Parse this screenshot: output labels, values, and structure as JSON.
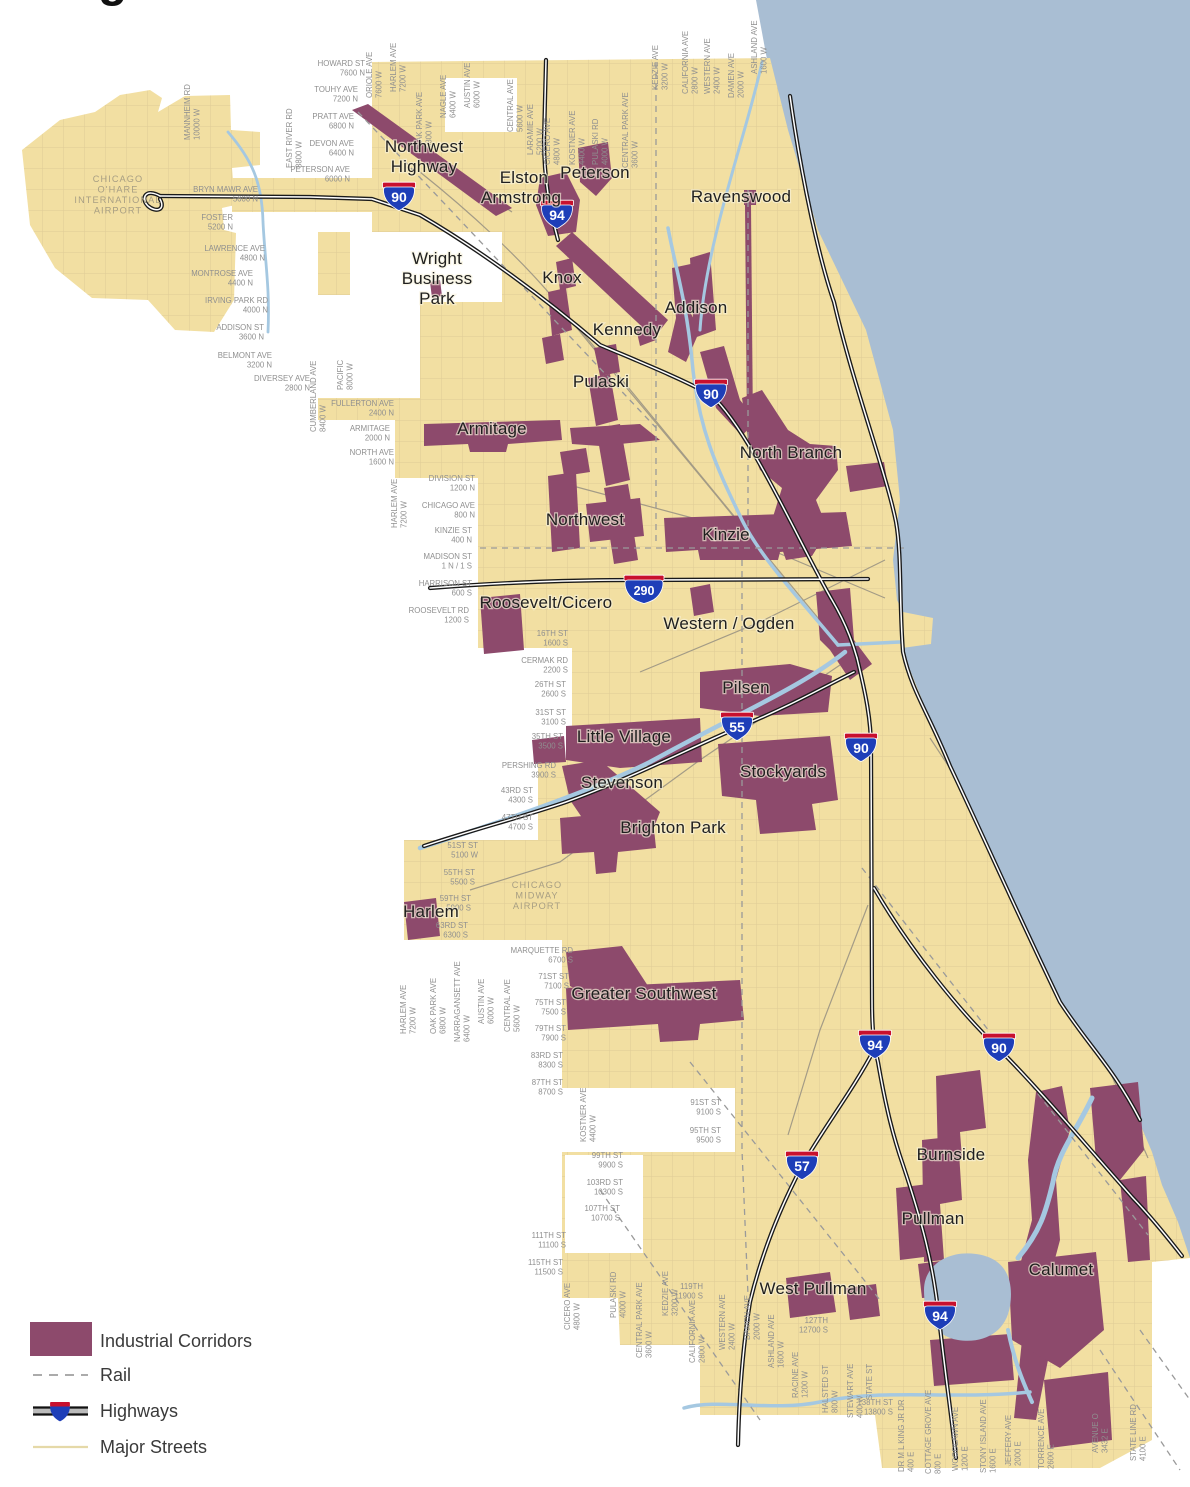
{
  "title_fragment": "g",
  "colors": {
    "land": "#F2DFA2",
    "lake": "#A9BED3",
    "river": "#A5C8E1",
    "corridor": "#8D4A6C",
    "street_grid": "#DFCB96",
    "rail": "#9A9A9A",
    "highway": "#1A1A1A",
    "shield_blue": "#1E3EB8",
    "shield_red": "#C8102E",
    "label_gray": "#8F8F8F"
  },
  "legend": {
    "items": [
      {
        "label": "Industrial Corridors",
        "symbol": "corridor-swatch"
      },
      {
        "label": "Rail",
        "symbol": "rail-dashed-line"
      },
      {
        "label": "Highways",
        "symbol": "highway-shield-line"
      },
      {
        "label": "Major Streets",
        "symbol": "street-line"
      }
    ]
  },
  "map": {
    "airport_labels": [
      {
        "lines": [
          "CHICAGO",
          "O'HARE",
          "INTERNATIONAL",
          "AIRPORT"
        ],
        "x": 118,
        "y": 182
      },
      {
        "lines": [
          "CHICAGO",
          "MIDWAY",
          "AIRPORT"
        ],
        "x": 537,
        "y": 888
      }
    ],
    "corridor_labels": [
      {
        "lines": [
          "Northwest",
          "Highway"
        ],
        "x": 424,
        "y": 152
      },
      {
        "lines": [
          "Elston"
        ],
        "x": 524,
        "y": 183
      },
      {
        "lines": [
          "Armstrong"
        ],
        "x": 521,
        "y": 203
      },
      {
        "lines": [
          "Peterson"
        ],
        "x": 595,
        "y": 178
      },
      {
        "lines": [
          "Ravenswood"
        ],
        "x": 741,
        "y": 202
      },
      {
        "lines": [
          "Wright",
          "Business",
          "Park"
        ],
        "x": 437,
        "y": 264
      },
      {
        "lines": [
          "Knox"
        ],
        "x": 562,
        "y": 283
      },
      {
        "lines": [
          "Addison"
        ],
        "x": 696,
        "y": 313
      },
      {
        "lines": [
          "Kennedy"
        ],
        "x": 627,
        "y": 335
      },
      {
        "lines": [
          "Pulaski"
        ],
        "x": 601,
        "y": 387
      },
      {
        "lines": [
          "Armitage"
        ],
        "x": 492,
        "y": 434
      },
      {
        "lines": [
          "North Branch"
        ],
        "x": 791,
        "y": 458
      },
      {
        "lines": [
          "Northwest"
        ],
        "x": 585,
        "y": 525
      },
      {
        "lines": [
          "Kinzie"
        ],
        "x": 726,
        "y": 540
      },
      {
        "lines": [
          "Roosevelt/Cicero"
        ],
        "x": 546,
        "y": 608
      },
      {
        "lines": [
          "Western / Ogden"
        ],
        "x": 729,
        "y": 629
      },
      {
        "lines": [
          "Pilsen"
        ],
        "x": 746,
        "y": 693
      },
      {
        "lines": [
          "Little Village"
        ],
        "x": 624,
        "y": 742
      },
      {
        "lines": [
          "Stevenson"
        ],
        "x": 622,
        "y": 788
      },
      {
        "lines": [
          "Stockyards"
        ],
        "x": 783,
        "y": 777
      },
      {
        "lines": [
          "Brighton Park"
        ],
        "x": 673,
        "y": 833
      },
      {
        "lines": [
          "Harlem"
        ],
        "x": 431,
        "y": 917
      },
      {
        "lines": [
          "Greater Southwest"
        ],
        "x": 644,
        "y": 999
      },
      {
        "lines": [
          "Burnside"
        ],
        "x": 951,
        "y": 1160
      },
      {
        "lines": [
          "Pullman"
        ],
        "x": 933,
        "y": 1224
      },
      {
        "lines": [
          "West Pullman"
        ],
        "x": 813,
        "y": 1294
      },
      {
        "lines": [
          "Calumet"
        ],
        "x": 1061,
        "y": 1275
      }
    ],
    "highway_shields": [
      {
        "route": "90",
        "x": 399,
        "y": 197
      },
      {
        "route": "94",
        "x": 557,
        "y": 215
      },
      {
        "route": "90",
        "x": 711,
        "y": 394
      },
      {
        "route": "290",
        "x": 644,
        "y": 590
      },
      {
        "route": "55",
        "x": 737,
        "y": 727
      },
      {
        "route": "90",
        "x": 861,
        "y": 748
      },
      {
        "route": "94",
        "x": 875,
        "y": 1045
      },
      {
        "route": "90",
        "x": 999,
        "y": 1048
      },
      {
        "route": "57",
        "x": 802,
        "y": 1166
      },
      {
        "route": "94",
        "x": 940,
        "y": 1316
      }
    ],
    "street_labels": [
      {
        "t": "HOWARD ST",
        "v": "7600 N",
        "x": 365,
        "y": 66
      },
      {
        "t": "TOUHY AVE",
        "v": "7200 N",
        "x": 358,
        "y": 92
      },
      {
        "t": "PRATT AVE",
        "v": "6800 N",
        "x": 354,
        "y": 119
      },
      {
        "t": "DEVON AVE",
        "v": "6400 N",
        "x": 354,
        "y": 146
      },
      {
        "t": "PETERSON AVE",
        "v": "6000 N",
        "x": 350,
        "y": 172
      },
      {
        "t": "BRYN MAWR AVE",
        "v": "5600 N",
        "x": 258,
        "y": 192
      },
      {
        "t": "FOSTER",
        "v": "5200 N",
        "x": 233,
        "y": 220
      },
      {
        "t": "LAWRENCE AVE",
        "v": "4800 N",
        "x": 265,
        "y": 251
      },
      {
        "t": "MONTROSE AVE",
        "v": "4400 N",
        "x": 253,
        "y": 276
      },
      {
        "t": "IRVING PARK RD",
        "v": "4000 N",
        "x": 268,
        "y": 303
      },
      {
        "t": "ADDISON ST",
        "v": "3600 N",
        "x": 264,
        "y": 330
      },
      {
        "t": "BELMONT AVE",
        "v": "3200 N",
        "x": 272,
        "y": 358
      },
      {
        "t": "DIVERSEY AVE",
        "v": "2800 N",
        "x": 310,
        "y": 381
      },
      {
        "t": "FULLERTON AVE",
        "v": "2400 N",
        "x": 394,
        "y": 406
      },
      {
        "t": "ARMITAGE",
        "v": "2000 N",
        "x": 390,
        "y": 431
      },
      {
        "t": "NORTH AVE",
        "v": "1600 N",
        "x": 394,
        "y": 455
      },
      {
        "t": "DIVISION ST",
        "v": "1200 N",
        "x": 475,
        "y": 481
      },
      {
        "t": "CHICAGO AVE",
        "v": "800 N",
        "x": 475,
        "y": 508
      },
      {
        "t": "KINZIE ST",
        "v": "400 N",
        "x": 472,
        "y": 533
      },
      {
        "t": "MADISON ST",
        "v": "1 N / 1 S",
        "x": 472,
        "y": 559
      },
      {
        "t": "HARRISON ST",
        "v": "600 S",
        "x": 472,
        "y": 586
      },
      {
        "t": "ROOSEVELT RD",
        "v": "1200 S",
        "x": 469,
        "y": 613
      },
      {
        "t": "16TH ST",
        "v": "1600 S",
        "x": 568,
        "y": 636
      },
      {
        "t": "CERMAK RD",
        "v": "2200 S",
        "x": 568,
        "y": 663
      },
      {
        "t": "26TH ST",
        "v": "2600 S",
        "x": 566,
        "y": 687
      },
      {
        "t": "31ST ST",
        "v": "3100 S",
        "x": 566,
        "y": 715
      },
      {
        "t": "35TH ST",
        "v": "3500 S",
        "x": 563,
        "y": 739
      },
      {
        "t": "PERSHING RD",
        "v": "3900 S",
        "x": 556,
        "y": 768
      },
      {
        "t": "43RD ST",
        "v": "4300 S",
        "x": 533,
        "y": 793
      },
      {
        "t": "47TH ST",
        "v": "4700 S",
        "x": 533,
        "y": 820
      },
      {
        "t": "51ST ST",
        "v": "5100 W",
        "x": 478,
        "y": 848
      },
      {
        "t": "55TH ST",
        "v": "5500 S",
        "x": 475,
        "y": 875
      },
      {
        "t": "59TH ST",
        "v": "5900 S",
        "x": 471,
        "y": 901
      },
      {
        "t": "63RD ST",
        "v": "6300 S",
        "x": 468,
        "y": 928
      },
      {
        "t": "MARQUETTE RD",
        "v": "6700 S",
        "x": 573,
        "y": 953
      },
      {
        "t": "71ST ST",
        "v": "7100 S",
        "x": 569,
        "y": 979
      },
      {
        "t": "75TH ST",
        "v": "7500 S",
        "x": 566,
        "y": 1005
      },
      {
        "t": "79TH ST",
        "v": "7900 S",
        "x": 566,
        "y": 1031
      },
      {
        "t": "83RD ST",
        "v": "8300 S",
        "x": 563,
        "y": 1058
      },
      {
        "t": "87TH ST",
        "v": "8700 S",
        "x": 563,
        "y": 1085
      },
      {
        "t": "91ST ST",
        "v": "9100 S",
        "x": 721,
        "y": 1105
      },
      {
        "t": "95TH ST",
        "v": "9500 S",
        "x": 721,
        "y": 1133
      },
      {
        "t": "99TH ST",
        "v": "9900 S",
        "x": 623,
        "y": 1158
      },
      {
        "t": "103RD ST",
        "v": "10300 S",
        "x": 623,
        "y": 1185
      },
      {
        "t": "107TH ST",
        "v": "10700 S",
        "x": 620,
        "y": 1211
      },
      {
        "t": "111TH ST",
        "v": "11100 S",
        "x": 566,
        "y": 1238
      },
      {
        "t": "115TH ST",
        "v": "11500 S",
        "x": 563,
        "y": 1265
      },
      {
        "t": "119TH",
        "v": "11900 S",
        "x": 703,
        "y": 1289
      },
      {
        "t": "127TH",
        "v": "12700 S",
        "x": 828,
        "y": 1323
      },
      {
        "t": "138TH ST",
        "v": "13800 S",
        "x": 893,
        "y": 1405
      },
      {
        "t": "MANNHEIM RD",
        "v": "10000 W",
        "x": 190,
        "y": 140,
        "vert": true
      },
      {
        "t": "EAST RIVER RD",
        "v": "8800 W",
        "x": 292,
        "y": 168,
        "vert": true
      },
      {
        "t": "ORIOLE AVE",
        "v": "7600 W",
        "x": 372,
        "y": 98,
        "vert": true
      },
      {
        "t": "HARLEM AVE",
        "v": "7200 W",
        "x": 396,
        "y": 92,
        "vert": true
      },
      {
        "t": "OAK PARK AVE",
        "v": "6800 W",
        "x": 422,
        "y": 148,
        "vert": true
      },
      {
        "t": "NAGLE AVE",
        "v": "6400 W",
        "x": 446,
        "y": 118,
        "vert": true
      },
      {
        "t": "AUSTIN AVE",
        "v": "6000 W",
        "x": 470,
        "y": 108,
        "vert": true
      },
      {
        "t": "CENTRAL AVE",
        "v": "5600 W",
        "x": 513,
        "y": 132,
        "vert": true
      },
      {
        "t": "LARAMIE AVE",
        "v": "5200 W",
        "x": 533,
        "y": 155,
        "vert": true
      },
      {
        "t": "CICERO AVE",
        "v": "4800 W",
        "x": 550,
        "y": 165,
        "vert": true
      },
      {
        "t": "KOSTNER AVE",
        "v": "4400 W",
        "x": 575,
        "y": 165,
        "vert": true
      },
      {
        "t": "PULASKI RD",
        "v": "4000 W",
        "x": 598,
        "y": 165,
        "vert": true
      },
      {
        "t": "CENTRAL PARK AVE",
        "v": "3600 W",
        "x": 628,
        "y": 168,
        "vert": true
      },
      {
        "t": "KEDZIE AVE",
        "v": "3200 W",
        "x": 658,
        "y": 90,
        "vert": true
      },
      {
        "t": "CALIFORNIA AVE",
        "v": "2800 W",
        "x": 688,
        "y": 94,
        "vert": true
      },
      {
        "t": "WESTERN AVE",
        "v": "2400 W",
        "x": 710,
        "y": 94,
        "vert": true
      },
      {
        "t": "DAMEN AVE",
        "v": "2000 W",
        "x": 734,
        "y": 98,
        "vert": true
      },
      {
        "t": "ASHLAND AVE",
        "v": "1600 W",
        "x": 757,
        "y": 74,
        "vert": true
      },
      {
        "t": "CUMBERLAND AVE",
        "v": "8400 W",
        "x": 316,
        "y": 432,
        "vert": true
      },
      {
        "t": "PACIFIC",
        "v": "8000 W",
        "x": 343,
        "y": 390,
        "vert": true
      },
      {
        "t": "HARLEM AVE",
        "v": "7200 W",
        "x": 397,
        "y": 528,
        "vert": true
      },
      {
        "t": "HARLEM AVE",
        "v": "7200 W",
        "x": 406,
        "y": 1034,
        "vert": true
      },
      {
        "t": "OAK PARK AVE",
        "v": "6800 W",
        "x": 436,
        "y": 1034,
        "vert": true
      },
      {
        "t": "NARRAGANSETT AVE",
        "v": "6400 W",
        "x": 460,
        "y": 1042,
        "vert": true
      },
      {
        "t": "AUSTIN AVE",
        "v": "6000 W",
        "x": 484,
        "y": 1024,
        "vert": true
      },
      {
        "t": "CENTRAL AVE",
        "v": "5600 W",
        "x": 510,
        "y": 1032,
        "vert": true
      },
      {
        "t": "KOSTNER AVE",
        "v": "4400 W",
        "x": 586,
        "y": 1142,
        "vert": true
      },
      {
        "t": "CICERO AVE",
        "v": "4800 W",
        "x": 570,
        "y": 1330,
        "vert": true
      },
      {
        "t": "PULASKI RD",
        "v": "4000 W",
        "x": 616,
        "y": 1318,
        "vert": true
      },
      {
        "t": "CENTRAL PARK AVE",
        "v": "3600 W",
        "x": 642,
        "y": 1358,
        "vert": true
      },
      {
        "t": "KEDZIE AVE",
        "v": "3200 W",
        "x": 668,
        "y": 1316,
        "vert": true
      },
      {
        "t": "CALIFORNIA AVE",
        "v": "2800 W",
        "x": 695,
        "y": 1363,
        "vert": true
      },
      {
        "t": "WESTERN AVE",
        "v": "2400 W",
        "x": 725,
        "y": 1350,
        "vert": true
      },
      {
        "t": "DAMEN AVE",
        "v": "2000 W",
        "x": 750,
        "y": 1340,
        "vert": true
      },
      {
        "t": "ASHLAND AVE",
        "v": "1600 W",
        "x": 774,
        "y": 1368,
        "vert": true
      },
      {
        "t": "RACINE AVE",
        "v": "1200 W",
        "x": 798,
        "y": 1398,
        "vert": true
      },
      {
        "t": "HALSTED ST",
        "v": "800 W",
        "x": 828,
        "y": 1413,
        "vert": true
      },
      {
        "t": "STEWART AVE",
        "v": "400 W",
        "x": 853,
        "y": 1418,
        "vert": true
      },
      {
        "t": "STATE ST",
        "v": "",
        "x": 872,
        "y": 1400,
        "vert": true
      },
      {
        "t": "DR M L KING JR DR",
        "v": "400 E",
        "x": 904,
        "y": 1472,
        "vert": true
      },
      {
        "t": "COTTAGE GROVE AVE",
        "v": "800 E",
        "x": 931,
        "y": 1474,
        "vert": true
      },
      {
        "t": "WOODLAWN AVE",
        "v": "1200 E",
        "x": 958,
        "y": 1471,
        "vert": true
      },
      {
        "t": "STONY ISLAND AVE",
        "v": "1600 E",
        "x": 986,
        "y": 1473,
        "vert": true
      },
      {
        "t": "JEFFERY AVE",
        "v": "2000 E",
        "x": 1011,
        "y": 1466,
        "vert": true
      },
      {
        "t": "TORRENCE AVE",
        "v": "2600 E",
        "x": 1044,
        "y": 1469,
        "vert": true
      },
      {
        "t": "AVENUE O",
        "v": "3432 E",
        "x": 1098,
        "y": 1453,
        "vert": true
      },
      {
        "t": "STATE LINE RD",
        "v": "4100 E",
        "x": 1136,
        "y": 1461,
        "vert": true
      }
    ]
  }
}
